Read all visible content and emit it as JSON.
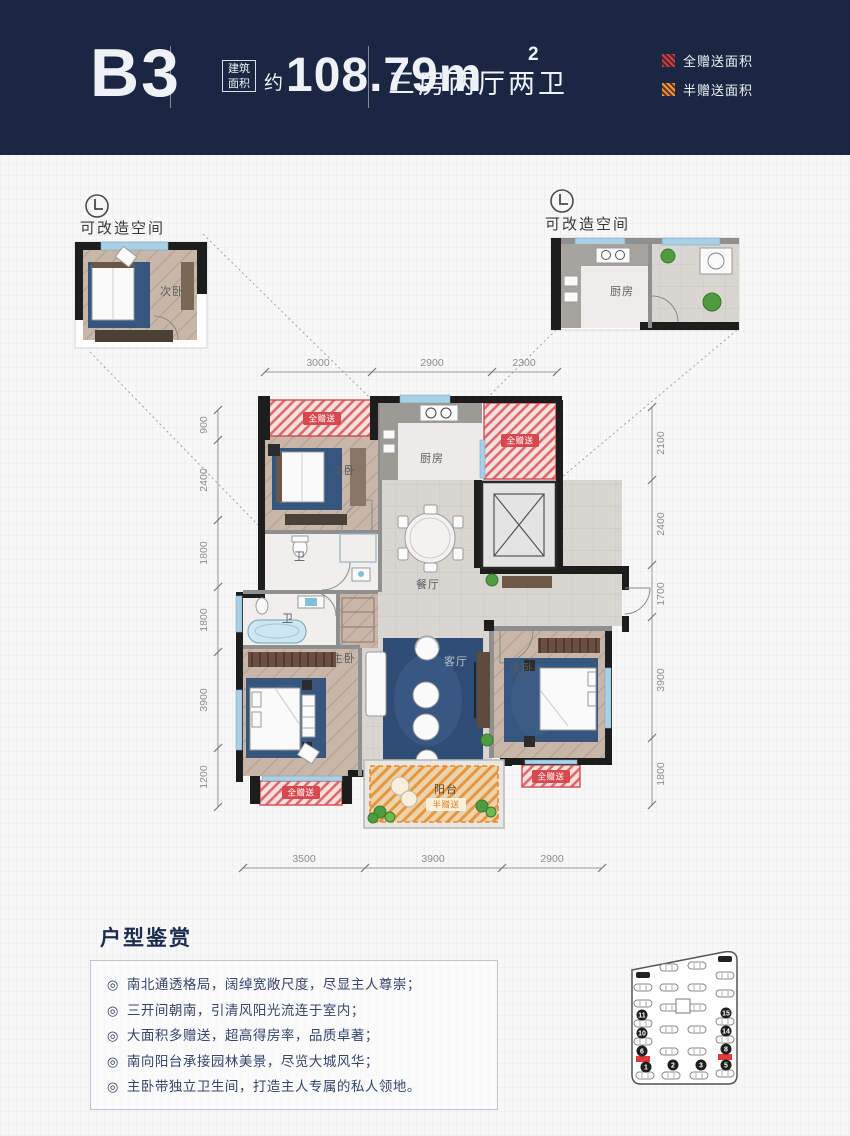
{
  "header": {
    "unit_code": "B3",
    "area_badge": [
      "建筑",
      "面积"
    ],
    "area_approx": "约",
    "area_value": "108.79m",
    "area_exponent": "2",
    "layout_type": "三房两厅两卫",
    "legend": {
      "full_gift": "全赠送面积",
      "half_gift": "半赠送面积"
    }
  },
  "callouts": {
    "left": {
      "title": "可改造空间",
      "room_label": "次卧"
    },
    "right": {
      "title": "可改造空间",
      "room_label": "厨房"
    }
  },
  "plan": {
    "rooms": {
      "bedroom_top": "次卧",
      "kitchen": "厨房",
      "dining": "餐厅",
      "bath_1": "卫",
      "bath_2": "卫",
      "master_bedroom": "主卧",
      "living": "客厅",
      "bedroom_right": "次卧",
      "balcony": "阳台"
    },
    "gift_full": "全赠送",
    "gift_half": "半赠送",
    "dims": {
      "top": [
        "3000",
        "2900",
        "2300"
      ],
      "bottom": [
        "3500",
        "3900",
        "2900"
      ],
      "left": [
        "900",
        "2400",
        "1800",
        "1800",
        "3900",
        "1200"
      ],
      "right": [
        "2100",
        "2400",
        "1700",
        "3900",
        "1800"
      ]
    }
  },
  "features": {
    "title": "户型鉴赏",
    "bullet": "◎",
    "items": [
      "南北通透格局，阔绰宽敞尺度，尽显主人尊崇；",
      "三开间朝南，引清风阳光流连于室内；",
      "大面积多赠送，超高得房率，品质卓著；",
      "南向阳台承接园林美景，尽览大城风华；",
      "主卧带独立卫生间，打造主人专属的私人领地。"
    ]
  },
  "site_map": {
    "building_numbers": [
      "1",
      "2",
      "3",
      "5",
      "6",
      "8",
      "10",
      "11",
      "14",
      "15"
    ]
  },
  "colors": {
    "header_bg": "#1b2742",
    "full_gift_red": "#d8484f",
    "half_gift_orange": "#e8892f",
    "rug_navy": "#35567e"
  }
}
